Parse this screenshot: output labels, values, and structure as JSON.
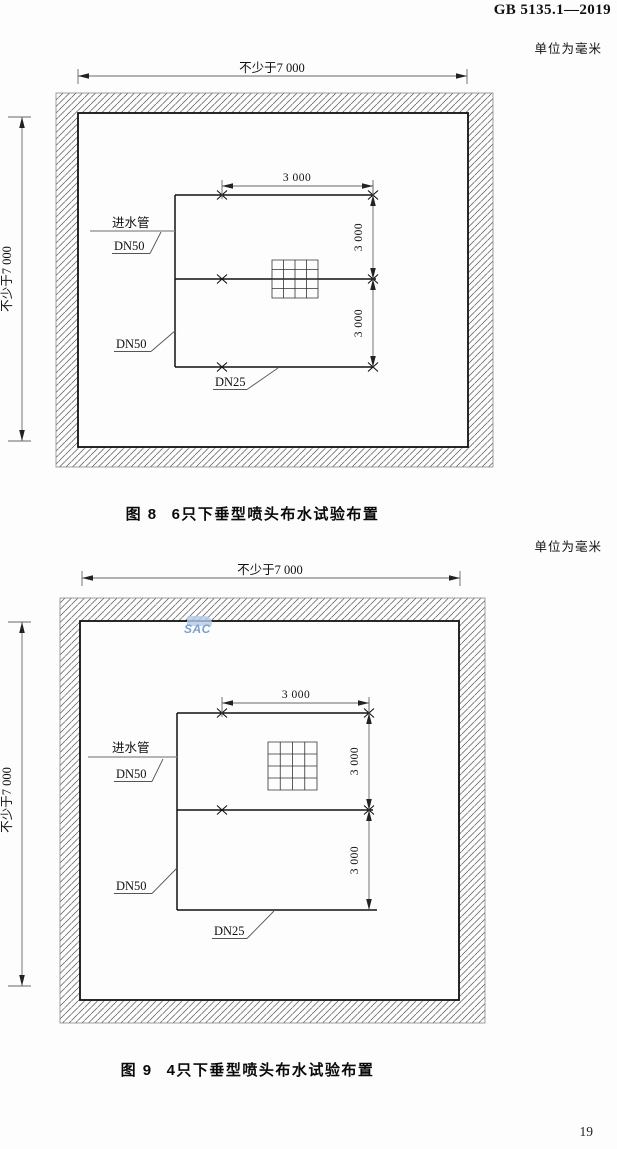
{
  "page": {
    "header_title": "GB 5135.1—2019",
    "page_number": "19",
    "watermark": "SAC"
  },
  "figure8": {
    "unit_note": "单位为毫米",
    "caption_label": "图 8",
    "caption_text": "6只下垂型喷头布水试验布置",
    "dim_width": "不少于7 000",
    "dim_height": "不少于7 000",
    "dim_spacing_top": "3 000",
    "dim_spacing_right_upper": "3 000",
    "dim_spacing_right_lower": "3 000",
    "label_inlet_pipe": "进水管",
    "label_dn50_upper": "DN50",
    "label_dn50_lower": "DN50",
    "label_dn25": "DN25"
  },
  "figure9": {
    "unit_note": "单位为毫米",
    "caption_label": "图 9",
    "caption_text": "4只下垂型喷头布水试验布置",
    "dim_width": "不少于7 000",
    "dim_height": "不少于7 000",
    "dim_spacing_top": "3 000",
    "dim_spacing_right_upper": "3 000",
    "dim_spacing_right_lower": "3 000",
    "label_inlet_pipe": "进水管",
    "label_dn50_upper": "DN50",
    "label_dn50_lower": "DN50",
    "label_dn25": "DN25"
  }
}
